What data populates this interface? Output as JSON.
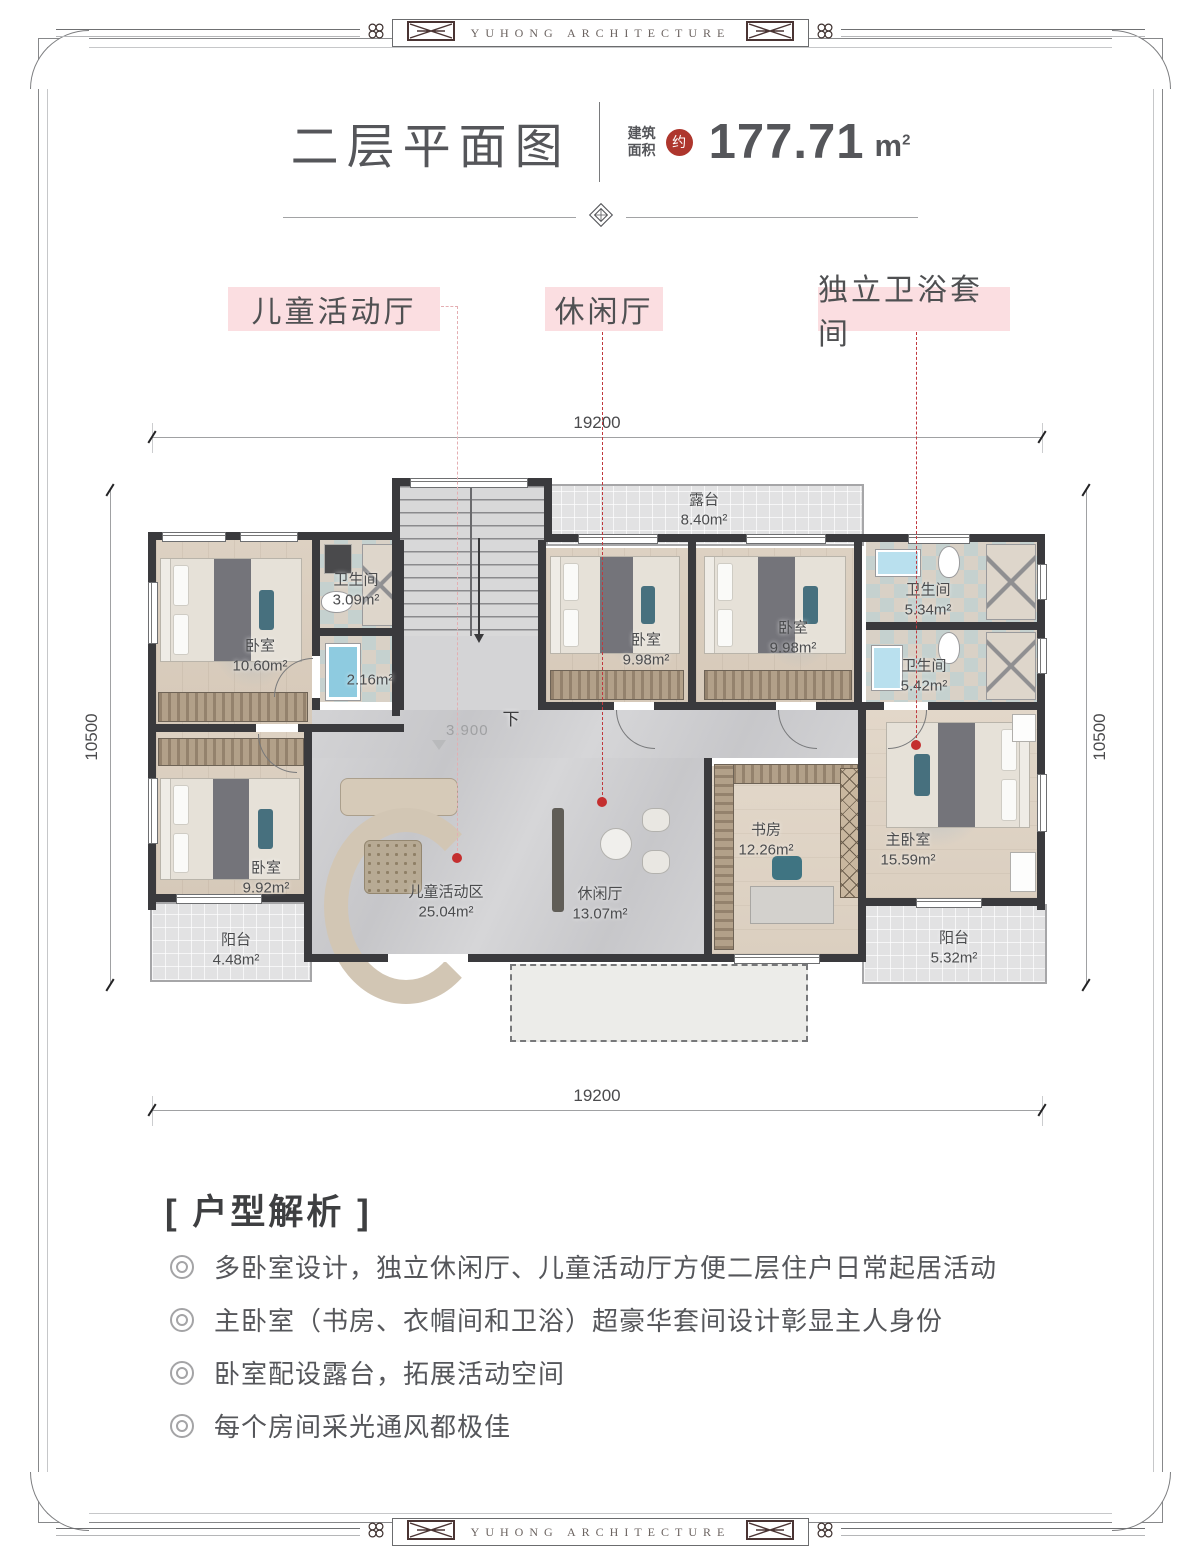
{
  "page": {
    "brand": "YUHONG ARCHITECTURE"
  },
  "header": {
    "title": "二层平面图",
    "area_label_line1": "建筑",
    "area_label_line2": "面积",
    "approx_badge": "约",
    "area_value": "177.71",
    "area_unit": "m",
    "area_unit_sup": "2"
  },
  "callouts": [
    {
      "label": "儿童活动厅"
    },
    {
      "label": "休闲厅"
    },
    {
      "label": "独立卫浴套间"
    }
  ],
  "dimensions": {
    "top": "19200",
    "bottom": "19200",
    "left": "10500",
    "right": "10500"
  },
  "plan": {
    "stairs_down_label": "下",
    "level_label": "3.900",
    "rooms": [
      {
        "name": "露台",
        "area": "8.40m²"
      },
      {
        "name": "卧室",
        "area": "10.60m²"
      },
      {
        "name": "卫生间",
        "area": "3.09m²"
      },
      {
        "name": "",
        "area": "2.16m²"
      },
      {
        "name": "卧室",
        "area": "9.98m²"
      },
      {
        "name": "卧室",
        "area": "9.98m²"
      },
      {
        "name": "卫生间",
        "area": "5.34m²"
      },
      {
        "name": "卫生间",
        "area": "5.42m²"
      },
      {
        "name": "卧室",
        "area": "9.92m²"
      },
      {
        "name": "阳台",
        "area": "4.48m²"
      },
      {
        "name": "儿童活动区",
        "area": "25.04m²"
      },
      {
        "name": "休闲厅",
        "area": "13.07m²"
      },
      {
        "name": "书房",
        "area": "12.26m²"
      },
      {
        "name": "主卧室",
        "area": "15.59m²"
      },
      {
        "name": "阳台",
        "area": "5.32m²"
      }
    ]
  },
  "analysis": {
    "heading": "[ 户型解析 ]",
    "bullets": [
      "多卧室设计，独立休闲厅、儿童活动厅方便二层住户日常起居活动",
      "主卧室（书房、衣帽间和卫浴）超豪华套间设计彰显主人身份",
      "卧室配设露台，拓展活动空间",
      "每个房间采光通风都极佳"
    ]
  },
  "colors": {
    "accent_red": "#ae362d",
    "callout_pink": "#fbdee1",
    "leader_red": "#c0393e",
    "wall": "#3a3a3d"
  }
}
